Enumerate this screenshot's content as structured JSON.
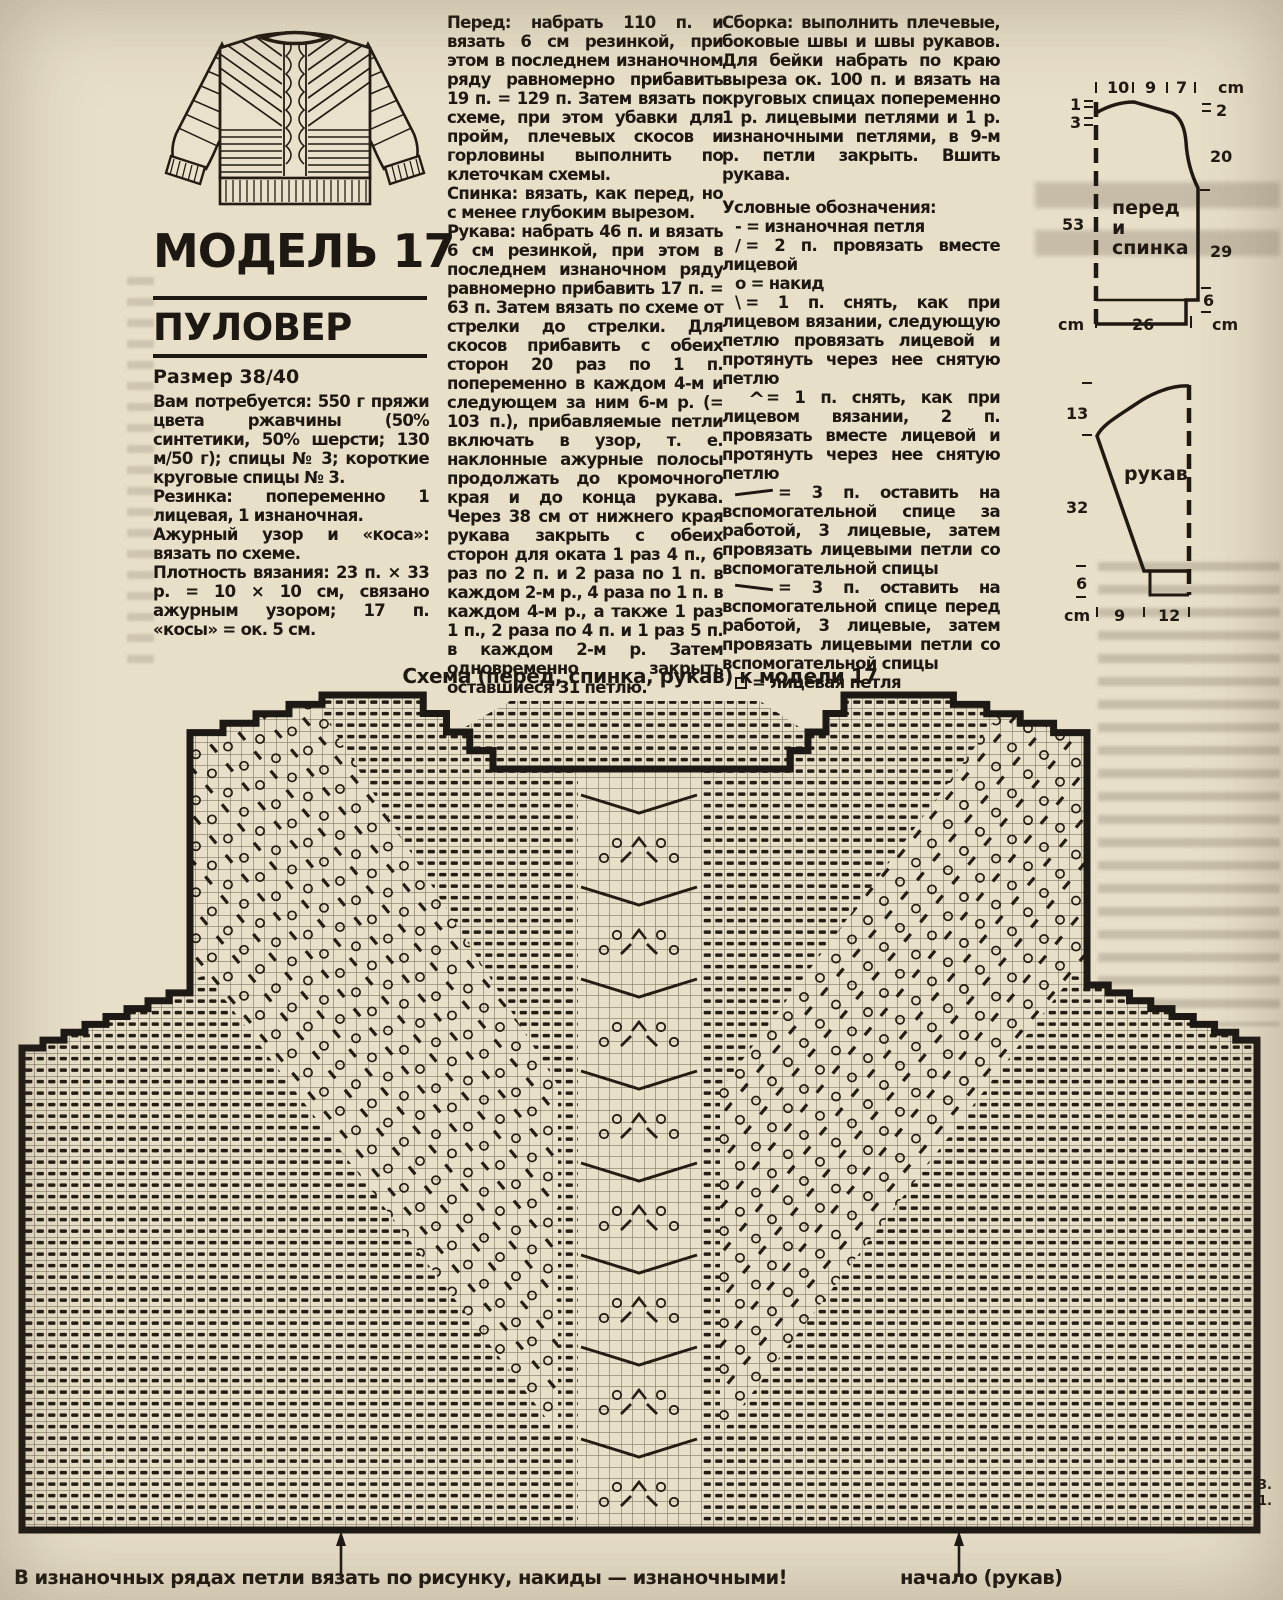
{
  "header": {
    "model_title": "МОДЕЛЬ 17",
    "garment_type": "ПУЛОВЕР",
    "size_label": "Размер 38/40"
  },
  "materials": {
    "needs": "Вам потребуется: 550 г пряжи цвета ржавчины (50% синтетики, 50% шерсти; 130 м/50 г); спицы № 3; короткие круговые спицы № 3.",
    "rib": "Резинка: попеременно 1 лицевая, 1 изнаночная.",
    "pattern": "Ажурный узор и «коса»: вязать по схеме.",
    "gauge": "Плотность вязания: 23 п. × 33 р. = 10 × 10 см, связано ажурным узором; 17 п. «косы» = ок. 5 см."
  },
  "instructions": {
    "front": "Перед: набрать 110 п. и вязать 6 см резинкой, при этом в последнем изнаночном ряду равномерно прибавить 19 п. = 129 п. Затем вязать по схеме, при этом убавки для пройм, плечевых скосов и горловины выполнить по клеточкам схемы.",
    "back": "Спинка: вязать, как перед, но с менее глубоким вырезом.",
    "sleeves": "Рукава: набрать 46 п. и вязать 6 см резинкой, при этом в последнем изнаночном ряду равномерно прибавить 17 п. = 63 п. Затем вязать по схеме от стрелки до стрелки. Для скосов прибавить с обеих сторон 20 раз по 1 п. попеременно в каждом 4-м и следующем за ним 6-м р. (= 103 п.), прибавляемые петли включать в узор, т. е. наклонные ажурные полосы продолжать до кромочного края и до конца рукава. Через 38 см от нижнего края рукава закрыть с обеих сторон для оката 1 раз 4 п., 6 раз по 2 п. и 2 раза по 1 п. в каждом 2-м р., 4 раза по 1 п. в каждом 4-м р., а также 1 раз 1 п., 2 раза по 4 п. и 1 раз 5 п. в каждом 2-м р. Затем одновременно закрыть оставшиеся 31 петлю.",
    "assembly": "Сборка: выполнить плечевые, боковые швы и швы рукавов. Для бейки набрать по краю выреза ок. 100 п. и вязать на круговых спицах попеременно 1 р. лицевыми петлями и 1 р. изнаночными петлями, в 9-м р. петли закрыть. Вшить рукава."
  },
  "legend": {
    "title": "Условные обозначения:",
    "items": [
      {
        "glyph": "purl-dash",
        "symbol": "-",
        "text": "= изнаночная петля"
      },
      {
        "glyph": "k2tog-slash",
        "symbol": "∕",
        "text": "= 2 п. провязать вместе лицевой"
      },
      {
        "glyph": "yarn-over-circle",
        "symbol": "о",
        "text": "= накид"
      },
      {
        "glyph": "slip-decrease-backslash",
        "symbol": "\\",
        "text": "= 1 п. снять, как при лицевом вязании, следующую петлю провязать лицевой и протянуть через нее снятую петлю"
      },
      {
        "glyph": "double-decrease-caret",
        "symbol": "^",
        "text": "= 1 п. снять, как при лицевом вязании, 2 п. провязать вместе лицевой и протянуть через нее снятую петлю"
      },
      {
        "glyph": "cable-back-line",
        "symbol": "",
        "text": "= 3 п. оставить на вспомогательной спице за работой, 3 лицевые, затем провязать лицевыми петли со вспомогательной спицы"
      },
      {
        "glyph": "cable-front-line",
        "symbol": "",
        "text": "= 3 п. оставить на вспомогательной спице перед работой, 3 лицевые, затем провязать лицевыми петли со вспомогательной спицы"
      },
      {
        "glyph": "knit-square",
        "symbol": "",
        "text": "= лицевая петля"
      }
    ]
  },
  "schematic_front_back": {
    "label_line1": "перед",
    "label_line2": "и",
    "label_line3": "спинка",
    "top_ticks": [
      "10",
      "9",
      "7"
    ],
    "top_unit": "cm",
    "left_ticks": [
      "1",
      "3",
      "53"
    ],
    "left_unit": "cm",
    "right_ticks": [
      "2",
      "20",
      "29",
      "6"
    ],
    "right_unit": "cm",
    "bottom_width": "26",
    "bottom_unit": "cm"
  },
  "schematic_sleeve": {
    "label": "рукав",
    "left_ticks": [
      "13",
      "32",
      "6"
    ],
    "bottom_ticks": [
      "9",
      "12"
    ],
    "bottom_unit": "cm"
  },
  "chart": {
    "caption": "Схема (перед, спинка, рукав) к модели 17",
    "row_numbers": [
      "3.",
      "1."
    ],
    "footnote": "В изнаночных рядах петли вязать по рисунку, накиды — изнаночными!",
    "sleeve_start_label": "начало (рукав)",
    "colors": {
      "ink": "#241d14",
      "grid": "#564a38",
      "bg": "#e7dfc8"
    }
  }
}
